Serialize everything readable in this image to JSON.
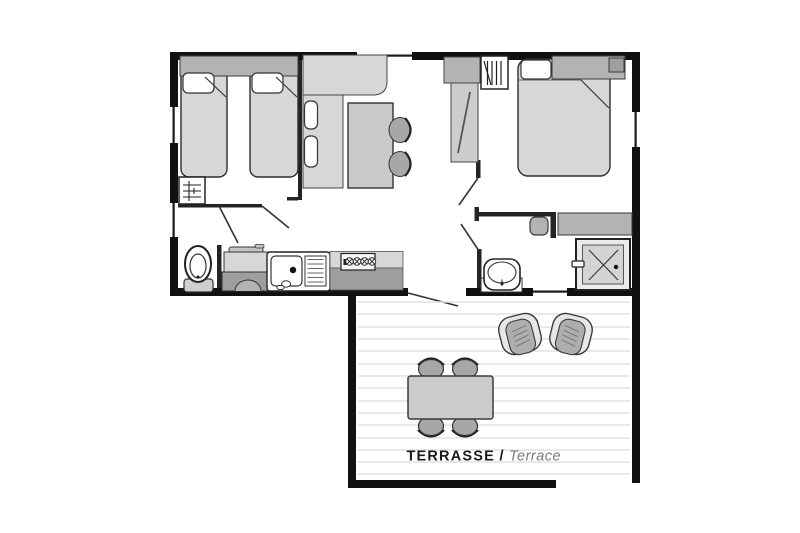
{
  "floorplan": {
    "terrace_label": {
      "primary": "TERRASSE",
      "separator": "/",
      "secondary": "Terrace"
    },
    "colors": {
      "wall": "#111111",
      "furniture_light": "#d7d7d7",
      "furniture_mid": "#b3b3b3",
      "furniture_dark": "#9e9e9e",
      "deck_line": "#e2e2e2",
      "background": "#ffffff",
      "label_primary": "#1a1a1a",
      "label_secondary": "#7a7a7a"
    },
    "rooms": [
      {
        "name": "children-bedroom",
        "furniture": [
          "single-bed",
          "single-bed",
          "wardrobe"
        ]
      },
      {
        "name": "living-dining",
        "furniture": [
          "corner-bench",
          "bench-cushions",
          "dining-table",
          "chairs"
        ]
      },
      {
        "name": "master-bedroom",
        "furniture": [
          "double-bed",
          "hanging-wardrobe",
          "tall-cabinet"
        ]
      },
      {
        "name": "wc",
        "furniture": [
          "toilet"
        ]
      },
      {
        "name": "kitchen",
        "furniture": [
          "fridge",
          "sink",
          "drainer",
          "hob"
        ]
      },
      {
        "name": "shower-room",
        "furniture": [
          "washbasin",
          "shower",
          "shelf",
          "stool"
        ]
      },
      {
        "name": "terrace",
        "furniture": [
          "outdoor-table",
          "outdoor-chairs",
          "lounge-chairs"
        ]
      }
    ]
  }
}
